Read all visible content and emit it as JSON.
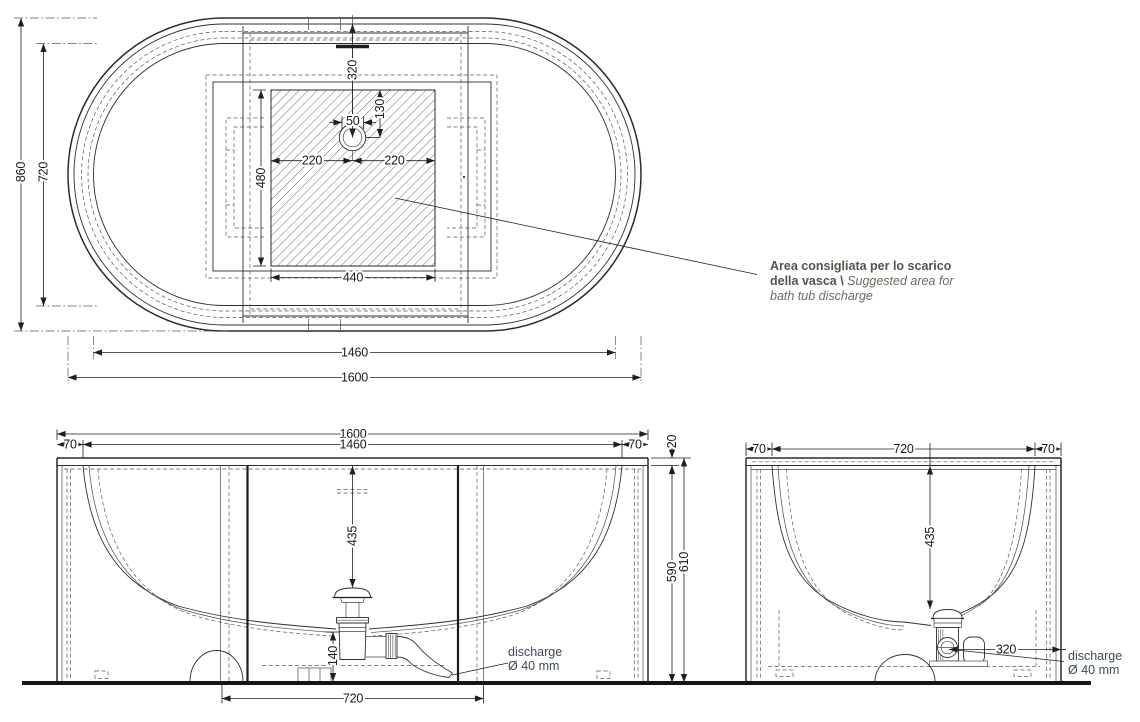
{
  "views": {
    "top": {
      "dims": {
        "overall_width": "860",
        "inner_width": "720",
        "rim_to_drain": "320",
        "area_top_to_drain": "130",
        "drain_offset": "50",
        "drain_left": "220",
        "drain_right": "220",
        "area_height": "480",
        "area_width": "440",
        "inner_length": "1460",
        "overall_length": "1600"
      },
      "annotation": {
        "it_1": "Area consigliata per lo scarico",
        "it_2": "della vasca \\",
        "en_1": "Suggested area for",
        "en_2": "bath tub discharge"
      }
    },
    "front": {
      "dims": {
        "overall_length": "1600",
        "inner_length": "1460",
        "overhang_left": "70",
        "overhang_right": "70",
        "rim_thickness": "20",
        "rim_to_drain": "435",
        "apron_height": "590",
        "overall_height": "610",
        "trap_height": "140",
        "center_panel": "720"
      },
      "discharge": {
        "word": "discharge",
        "size": "Ø 40 mm"
      }
    },
    "side": {
      "dims": {
        "overhang_left": "70",
        "inner_width": "720",
        "overhang_right": "70",
        "rim_to_drain": "435",
        "drain_to_edge": "320"
      },
      "discharge": {
        "word": "discharge",
        "size": "Ø 40 mm"
      }
    }
  },
  "colors": {
    "line": "#2a2a2a",
    "dim_text": "#1a1a1a",
    "annotation_text": "#57544c",
    "annotation_secondary": "#6e6a60",
    "discharge_text": "#3c4a57",
    "background": "#ffffff"
  }
}
